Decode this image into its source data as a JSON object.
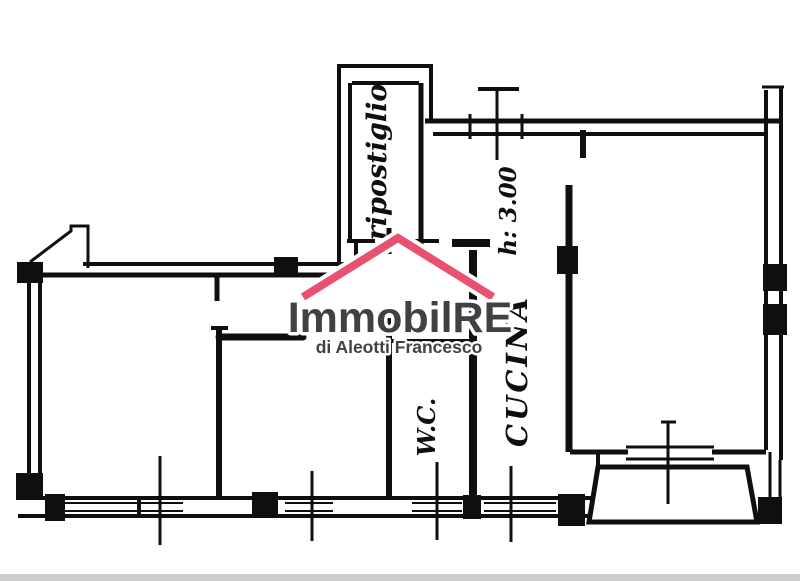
{
  "plan": {
    "labels": {
      "storage_room": "ripostiglio",
      "ceiling_height": "h: 3.00",
      "wc": "W.C.",
      "kitchen": "CUCINA"
    },
    "colors": {
      "ink": "#0f0f0f",
      "roof_pink": "#e8516f",
      "logo_gray": "#414145",
      "artifact_gray": "#cccccc"
    }
  },
  "watermark": {
    "brand": "ImmobilRE",
    "subtitle": "di Aleotti Francesco"
  }
}
